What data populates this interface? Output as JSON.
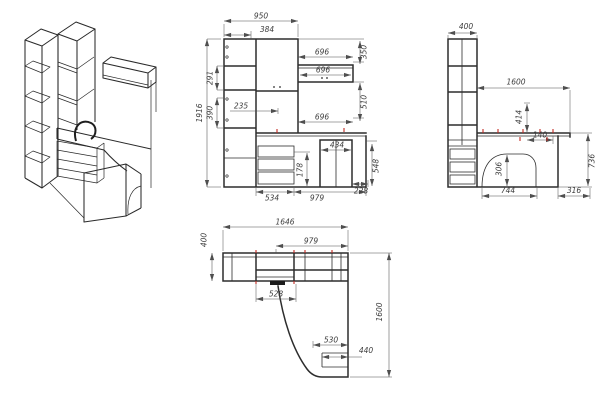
{
  "drawing": {
    "front": {
      "overall_width": "950",
      "left_column_width": "384",
      "overall_height": "1916",
      "upper_section": "291",
      "mid_section": "390",
      "inner_width": "235",
      "shelf_width_top": "696",
      "shelf_width_mid": "696",
      "shelf_width_low": "696",
      "shelf_drop": "350",
      "gap_height": "510",
      "cabinet_width": "434",
      "desk_height": "548",
      "drawer_pitch": "178",
      "drawer_width": "534",
      "desk_width": "979",
      "overhang": "228"
    },
    "side": {
      "depth": "400",
      "desk_length": "1600",
      "riser_height": "414",
      "inset": "140",
      "cutout_height": "306",
      "desk_surface_height": "736",
      "cutout_width": "744",
      "end_panel": "316"
    },
    "plan": {
      "overall_width": "1646",
      "desk_width": "979",
      "depth": "400",
      "inner_width": "528",
      "cutout_width": "530",
      "leg_width": "440",
      "desk_length": "1600"
    },
    "colors": {
      "line": "#2d2d2d",
      "dimension": "#4f4f4f",
      "marker_red": "#c22a22",
      "background": "#ffffff"
    }
  }
}
